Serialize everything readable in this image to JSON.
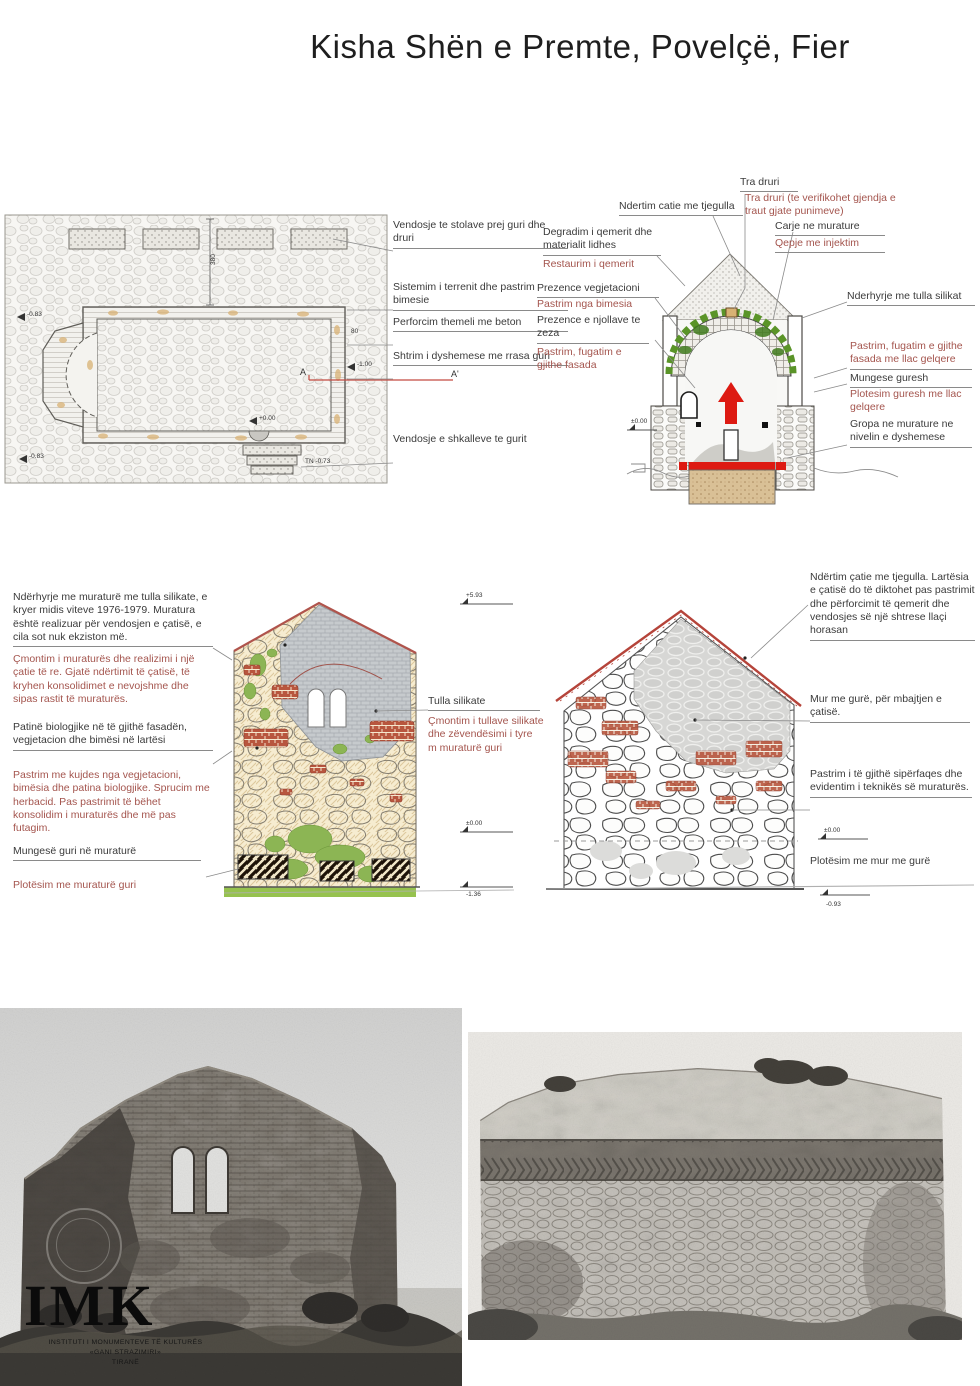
{
  "title": "Kisha Shën e Premte, Povelçë, Fier",
  "colors": {
    "annotation_black": "#3b3b3b",
    "annotation_red": "#a4554e",
    "drawing_red": "#dd1a12",
    "section_line_red": "#c34b42",
    "vegetation_green": "#6fae3a",
    "foundation_tan": "#d9c096",
    "silicate_gray": "#c6cacd",
    "roof_tile_red": "#b5443a"
  },
  "plan": {
    "annotations": [
      "Vendosje te stolave prej guri dhe druri",
      "Sistemim i terrenit dhe pastrim bimesie",
      "Perforcim themeli me beton",
      "Shtrim i dyshemese me rrasa guri",
      "Vendosje e shkalleve te gurit"
    ],
    "marks": {
      "left_top": "-0.83",
      "left_bottom": "-0.83",
      "right": "-1.00",
      "stair_top": "+0.00",
      "tn": "TN -0.73",
      "dim": "380",
      "dim_right": "80",
      "section_a": "A",
      "section_a_prime": "A'"
    }
  },
  "section": {
    "top_labels": {
      "tra_druri": "Tra druri",
      "tra_druri_note": "Tra druri (te verifikohet gjendja e traut gjate punimeve)",
      "catia": "Ndertim catie me tjegulla",
      "carje": "Carje ne murature",
      "qepje": "Qepje me injektim"
    },
    "left_labels": {
      "degradim": "Degradim i qemerit dhe materialit lidhes",
      "restaurim": "Restaurim i qemerit",
      "prezence_veg": "Prezence vegjetacioni",
      "pastrim_bimesia": "Pastrim nga bimesia",
      "njolla": "Prezence e njollave te zeza",
      "pastrim_fasada": "Pastrim, fugatim e gjithe fasada"
    },
    "right_labels": {
      "tulla": "Nderhyrje me tulla silikat",
      "pastrim_llac": "Pastrim, fugatim e gjithe fasada me llac gelqere",
      "mungese": "Mungese guresh",
      "plotesim": "Plotesim  guresh me llac gelqere",
      "gropa": "Gropa ne murature ne nivelin e dyshemese"
    },
    "marks": {
      "zero": "±0.00"
    }
  },
  "elevation_left": {
    "notes": {
      "p1": "Ndërhyrje me muraturë me tulla silikate, e kryer midis viteve 1976-1979. Muratura është realizuar për vendosjen e çatisë, e cila sot nuk ekziston më.",
      "p2": "Çmontim i muraturës dhe realizimi i një çatie të re. Gjatë ndërtimit të çatisë, të kryhen konsolidimet e nevojshme dhe sipas rastit të muraturës.",
      "p3": "Patinë biologjike në  të gjithë fasadën, vegjetacion dhe bimësi në lartësi",
      "p4": "Pastrim me kujdes nga vegjetacioni, bimësia dhe patina biologjike. Sprucim me herbacid. Pas pastrimit të bëhet konsolidim i muraturës dhe më pas futagim.",
      "p5": "Mungesë guri në muraturë",
      "p6": "Plotësim me muraturë guri"
    },
    "mid_labels": {
      "tulla": "Tulla silikate",
      "cmontim": "Çmontim i tullave silikate dhe zëvendësimi i tyre m muraturë guri"
    },
    "marks": {
      "top": "+5.93",
      "zero": "±0.00",
      "bottom": "-1.36"
    }
  },
  "elevation_right": {
    "labels": {
      "l1": "Ndërtim çatie me tjegulla. Lartësia e çatisë do të diktohet pas pastrimit dhe përforcimit të qemerit dhe vendosjes së një shtrese llaçi horasan",
      "l2": "Mur me gurë, për mbajtjen e çatisë.",
      "l3": "Pastrim i të gjithë sipërfaqes dhe evidentim i teknikës së muraturës.",
      "l4": "Plotësim me mur me gurë"
    },
    "marks": {
      "zero": "±0.00",
      "bottom": "-0.93"
    }
  },
  "logo": {
    "acronym": "IMK",
    "line1": "INSTITUTI I MONUMENTEVE TË KULTURËS",
    "line2": "«GANI STRAZIMIRI»",
    "line3": "TIRANË"
  }
}
